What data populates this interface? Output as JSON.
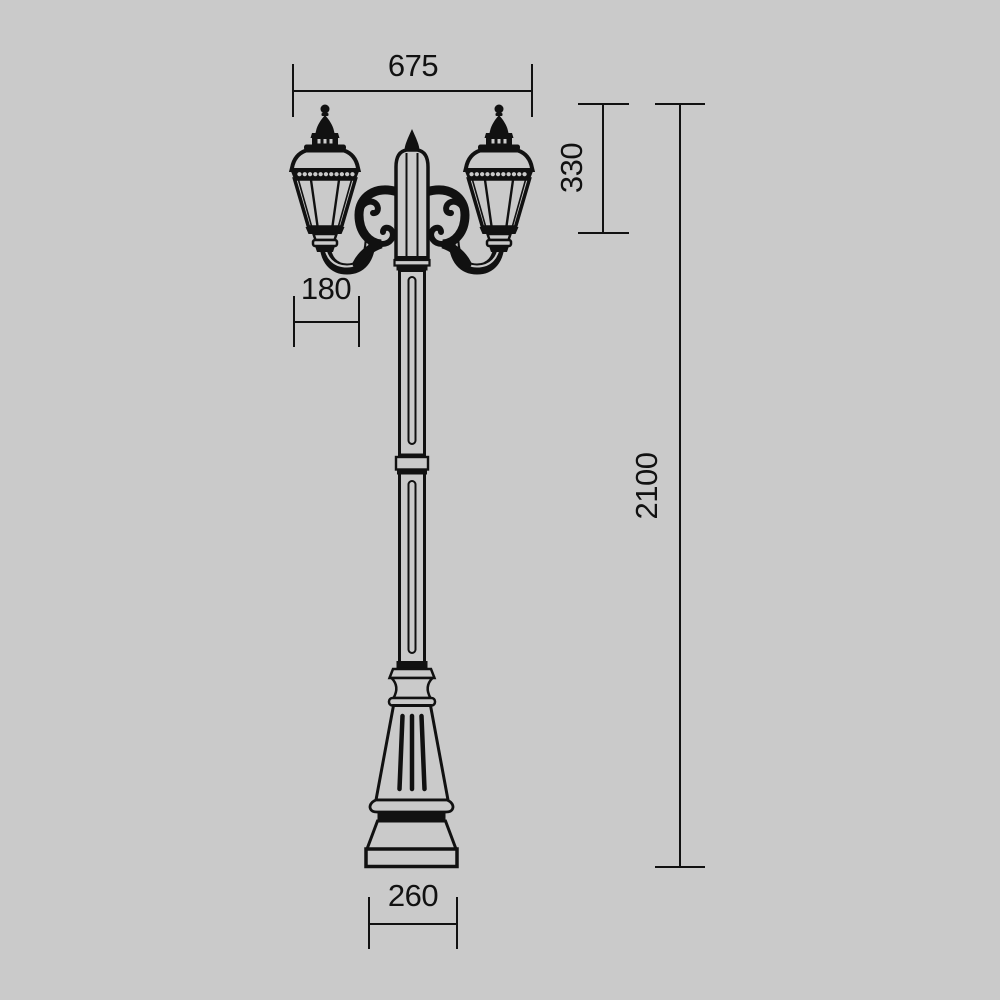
{
  "page": {
    "background_color": "#cacaca",
    "line_color": "#111111"
  },
  "drawing": {
    "subject": "two-arm-lamp-post-dimension-drawing",
    "dimensions": {
      "overall_width": "675",
      "lantern_height": "330",
      "lantern_width": "180",
      "overall_height": "2100",
      "base_width": "260"
    }
  }
}
